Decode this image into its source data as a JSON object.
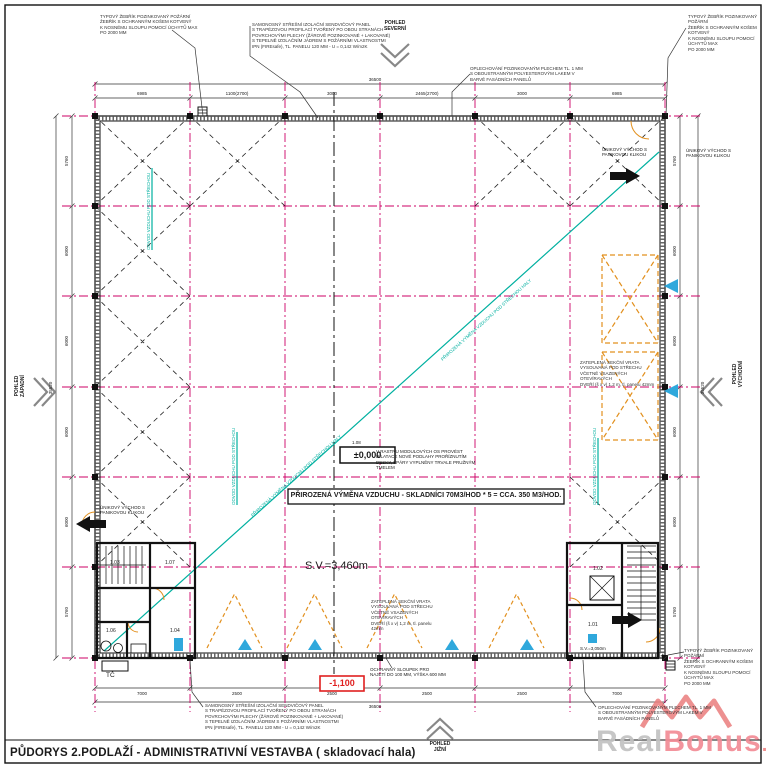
{
  "title": "PŮDORYS 2.PODLAŽÍ - ADMINISTRATIVNÍ VESTAVBA ( skladovací hala)",
  "views": {
    "north": "POHLED\nSEVERNÍ",
    "south": "POHLED\nJIŽNÍ",
    "west": "POHLED\nZÁPADNÍ",
    "east": "POHLED\nVÝCHODNÍ"
  },
  "notes": {
    "ladder": "TYPOVÝ ŽEBŘÍK POZINKOVANÝ POŽÁRNÍ\nŽEBŘÍK S OCHRANNÝM KOŠEM KOTVENÝ\nK NOSNÉMU SLOUPU POMOCÍ ÚCHYTŮ MAX\nPO 2000 MM",
    "roof_panel": "SAMONOSNÝ STŘEŠNÍ IZOLAČNÍ SENDVIČOVÝ PANEL\nS TRAPÉZOVOU PROFILACÍ TVOŘENÝ PO OBOU STRANÁCH\nPOVRCHOVÝMI PLECHY (ŽÁROVĚ POZINKOVANÉ + LAKOVANÉ)\nS TEPELNĚ IZOLAČNÍM JÁDREM S POŽÁRNÍMI VLASTNOSTMI\nIPN (FIREsafe), TL. PANELU 120 MM - U = 0,142 W/m2K",
    "flashing": "OPLECHOVÁNÍ POZINKOVANÝM PLECHEM TL. 1 MM\nS OBOUSTRANNÝM POLYESTEROVÝM LAKEM V\nBARVĚ FASÁDNÍCH PANELŮ",
    "dilatation": "V RASTRU MODULOVÝCH OS PROVÉST\nDILATACE NOVÉ PODLAHY PROŘÍZNUTÍM\nDESKY, SPÁRY VYPLNĚNY TRVALE PRUŽNÝM\nTMELEM",
    "gate": "ZATEPLENÁ SEKČNÍ VRATA\nVYSOUVANÁ POD STŘECHU\nVČETNĚ VSAZENÝCH OTEVÍRAVÝCH\nDVEŘÍ (š x v) 1,2 m, tl. panelu 42mm",
    "exit": "ÚNIKOVÝ VÝCHOD S\nPANIKOVOU KLIKOU",
    "bollard": "OCHRANNÝ SLOUPEK PRO\nNAJETÍ DO 100 MM, VÝŠKA 600 MM",
    "air_exchange": "PŘIROZENÁ VÝMĚNA VZDUCHU - SKLADNÍCI 70M3/HOD * 5 = CCA. 350 M3/HOD.",
    "diagonal": "PŘIROZENÁ VÝMĚNA VZDUCHU POD STŘECHOU HALY",
    "vent": "ODVOD VZDUCHU POD STŘECHOU"
  },
  "labels": {
    "plus_level": "±0,000",
    "minus_level": "-1,100",
    "hall_height": "S.V.=3,460m",
    "stair_height": "S.V.=3,050m",
    "heat_pump": "TČ",
    "hall_room": "1.08"
  },
  "rooms": {
    "r101": "1.01",
    "r102": "1.02",
    "r103": "1.03",
    "r104": "1.04",
    "r106": "1.06",
    "r107": "1.07"
  },
  "dims": {
    "top": [
      "6985",
      "1100(2700)",
      "3000",
      "2465(2700)",
      "3000",
      "6985"
    ],
    "top_overall": "36500",
    "bottom": [
      "7000",
      "2500",
      "2500",
      "2500",
      "2500",
      "7000"
    ],
    "bottom_overall": "36500",
    "left": [
      "5760",
      "6000",
      "6000",
      "6000",
      "6000",
      "5760"
    ],
    "left_overall": "35520",
    "right": [
      "5760",
      "6000",
      "6000",
      "6000",
      "6000",
      "5760"
    ],
    "right_overall": "35520"
  },
  "watermark": {
    "real": "Real",
    "bonus": "Bonus",
    "tld": ".cz"
  },
  "colors": {
    "grid_axis": "#cc0066",
    "bracing": "#222222",
    "ventilation": "#00b0a0",
    "gates": "#e2901e",
    "markers": "#2fa8dc",
    "level_warning": "#e02020"
  }
}
